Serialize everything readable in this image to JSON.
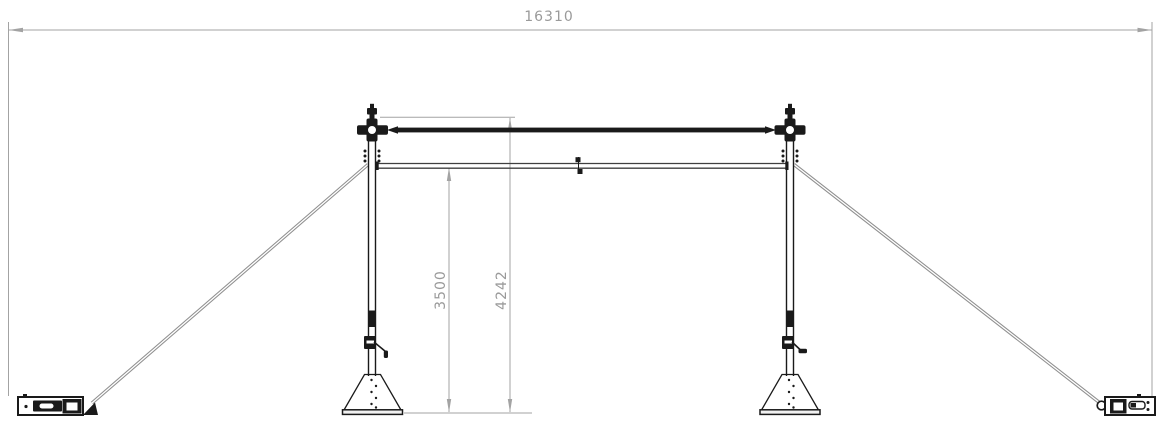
{
  "drawing": {
    "dimensions": {
      "overall_width_mm": "16310",
      "rail_height_mm": "3500",
      "overall_height_mm": "4242"
    },
    "colors": {
      "background": "#ffffff",
      "structure_line": "#1a1a1a",
      "secondary_line": "#3f3f3f",
      "dimension_line": "#a3a3a3",
      "dimension_text": "#9a9a9a",
      "wire": "#8f8f8f"
    }
  }
}
